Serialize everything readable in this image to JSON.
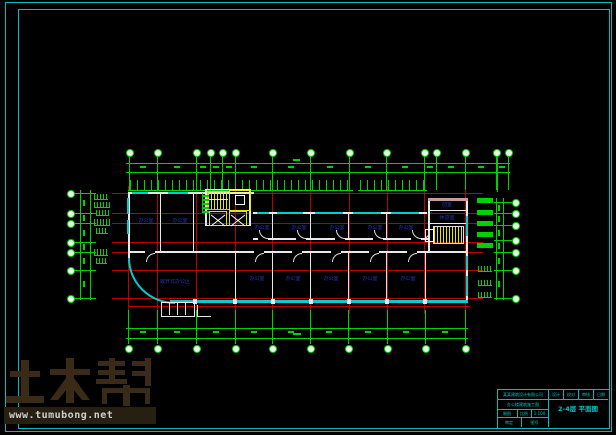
{
  "watermark": {
    "brand": "土木帮",
    "url": "www.tumubong.net",
    "brand_color": "#3a2a18",
    "band_bg": "#281f13",
    "url_color": "#cfcfcf"
  },
  "title_block": {
    "company": "某某建筑设计有限公司",
    "header_cells": [
      "设计",
      "校对",
      "审核",
      "日期"
    ],
    "project": "办公楼建筑施工图",
    "row3_cells": [
      "制图",
      "比例",
      "1:100"
    ],
    "row4_cells": [
      "审定",
      "图号"
    ],
    "drawing_title": "2-4层 平面图"
  },
  "rooms": {
    "upper": [
      "办公室",
      "办公室",
      "办公室",
      "办公室",
      "办公室",
      "办公室",
      "办公室"
    ],
    "lower": [
      "敞开式办公区",
      "办公室",
      "办公室",
      "办公室",
      "办公室",
      "办公室"
    ],
    "tower": [
      "前室",
      "休息室"
    ]
  },
  "colors": {
    "grid_green": "#00d200",
    "grid_red": "#bb0000",
    "wall_white": "#e8e8e8",
    "window_cyan": "#00cfcf",
    "stair_yellow": "#e6e600",
    "label_blue": "#2635c4",
    "border_cyan": "#00bdbd",
    "pink_wall": "#c89c9c"
  }
}
